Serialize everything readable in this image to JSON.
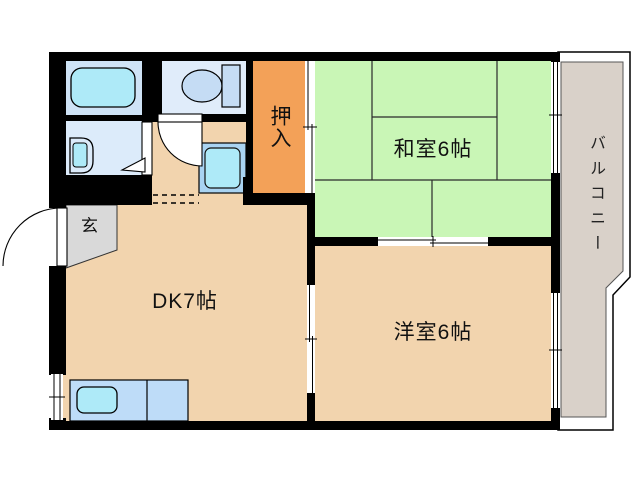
{
  "floorplan": {
    "rooms": {
      "washitsu": {
        "label": "和室6帖"
      },
      "yoshitsu": {
        "label": "洋室6帖"
      },
      "dk": {
        "label": "DK7帖"
      },
      "oshiire": {
        "label": "押入"
      },
      "genkan": {
        "label": "玄"
      },
      "balcony": {
        "label": "バルコニー"
      }
    },
    "colors": {
      "wall": "#000000",
      "line": "#2a2a2a",
      "beige": "#f2d4ae",
      "green": "#c9f6b6",
      "orange": "#f3a158",
      "genkan_gray": "#d9d9d9",
      "balcony_gray": "#d9d1c9",
      "bath": "#cfe3f6",
      "washroom": "#dcebfa",
      "toilet_room": "#e0ecfa",
      "fixture_cyan": "#aeeaf8",
      "fixture_blue": "#c5dcf4",
      "counter_blue": "#bedcf8",
      "pan_blue": "#a9d3f2"
    }
  }
}
